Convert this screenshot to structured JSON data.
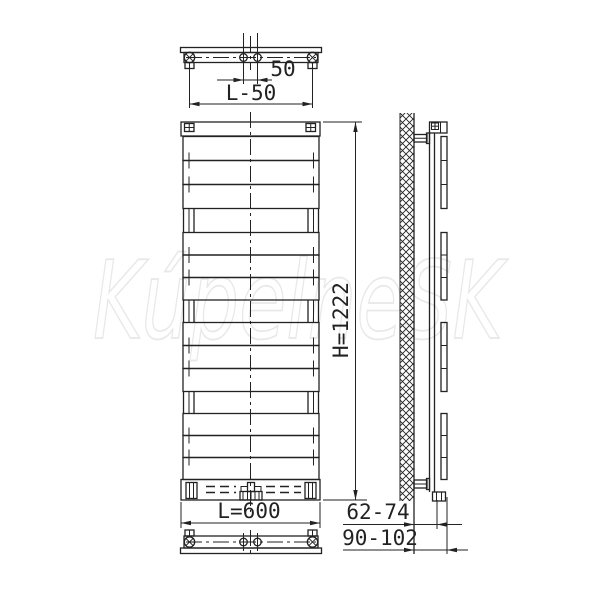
{
  "title": "Towel radiator technical drawing",
  "watermark": {
    "text": "KúpelneSK"
  },
  "dims": {
    "port_spacing": "50",
    "bracket_spacing": "L-50",
    "width": "L=600",
    "height": "H=1222",
    "wall_to_pipe": "62-74",
    "wall_to_face": "90-102"
  },
  "colors": {
    "line": "#222222",
    "watermark": "#e8e8e8",
    "background": "#ffffff"
  }
}
